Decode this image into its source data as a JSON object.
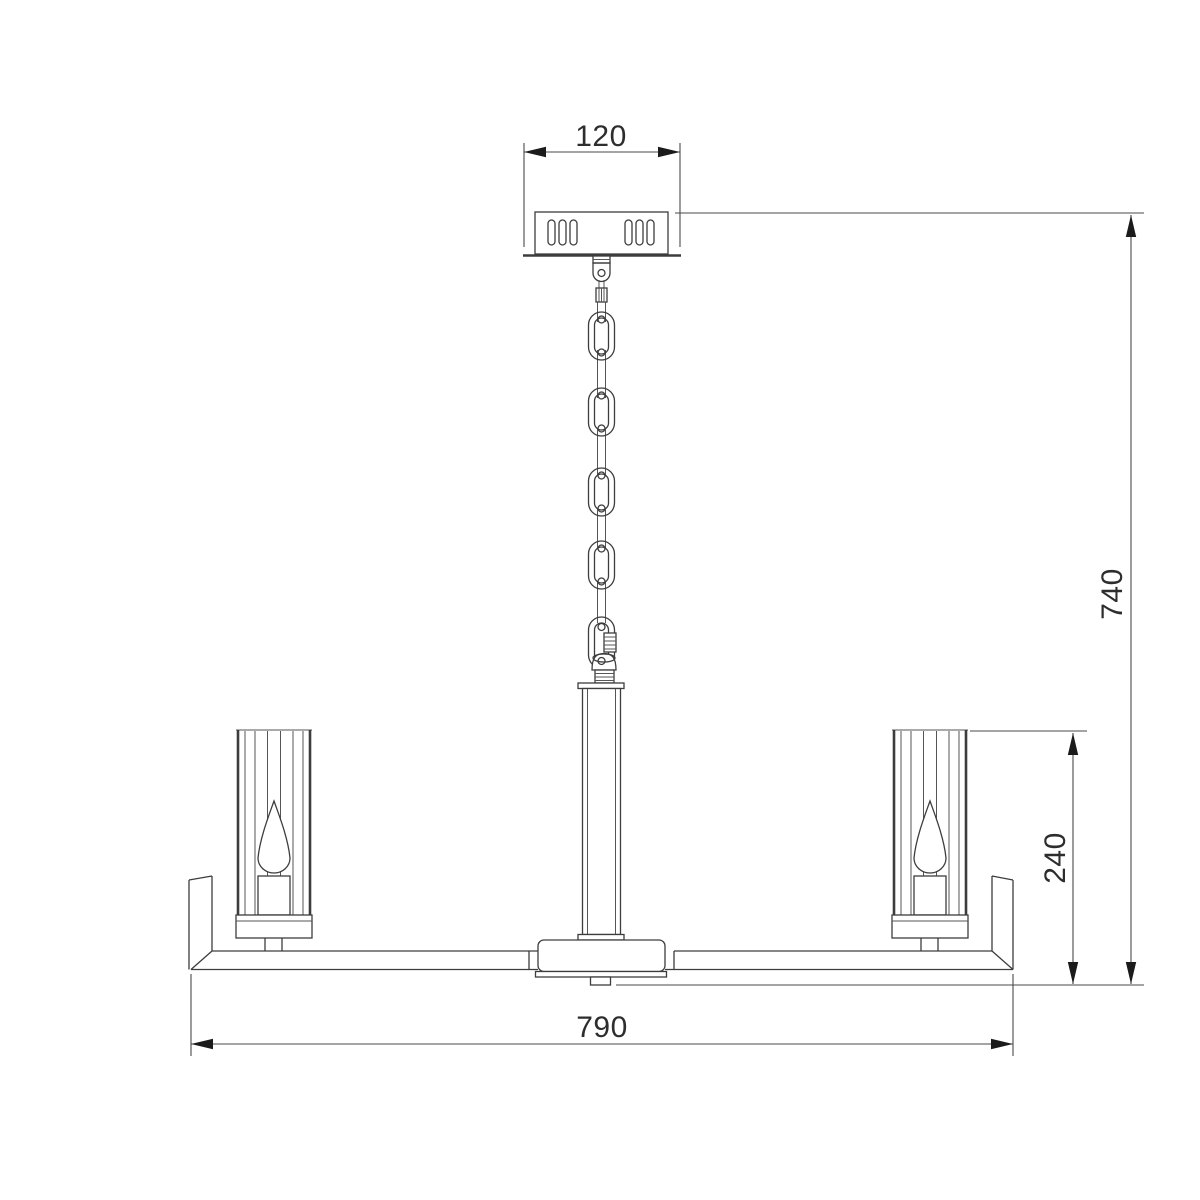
{
  "drawing": {
    "dimensions": {
      "canopy_width": "120",
      "overall_height": "740",
      "shade_height": "240",
      "frame_width": "790"
    }
  }
}
